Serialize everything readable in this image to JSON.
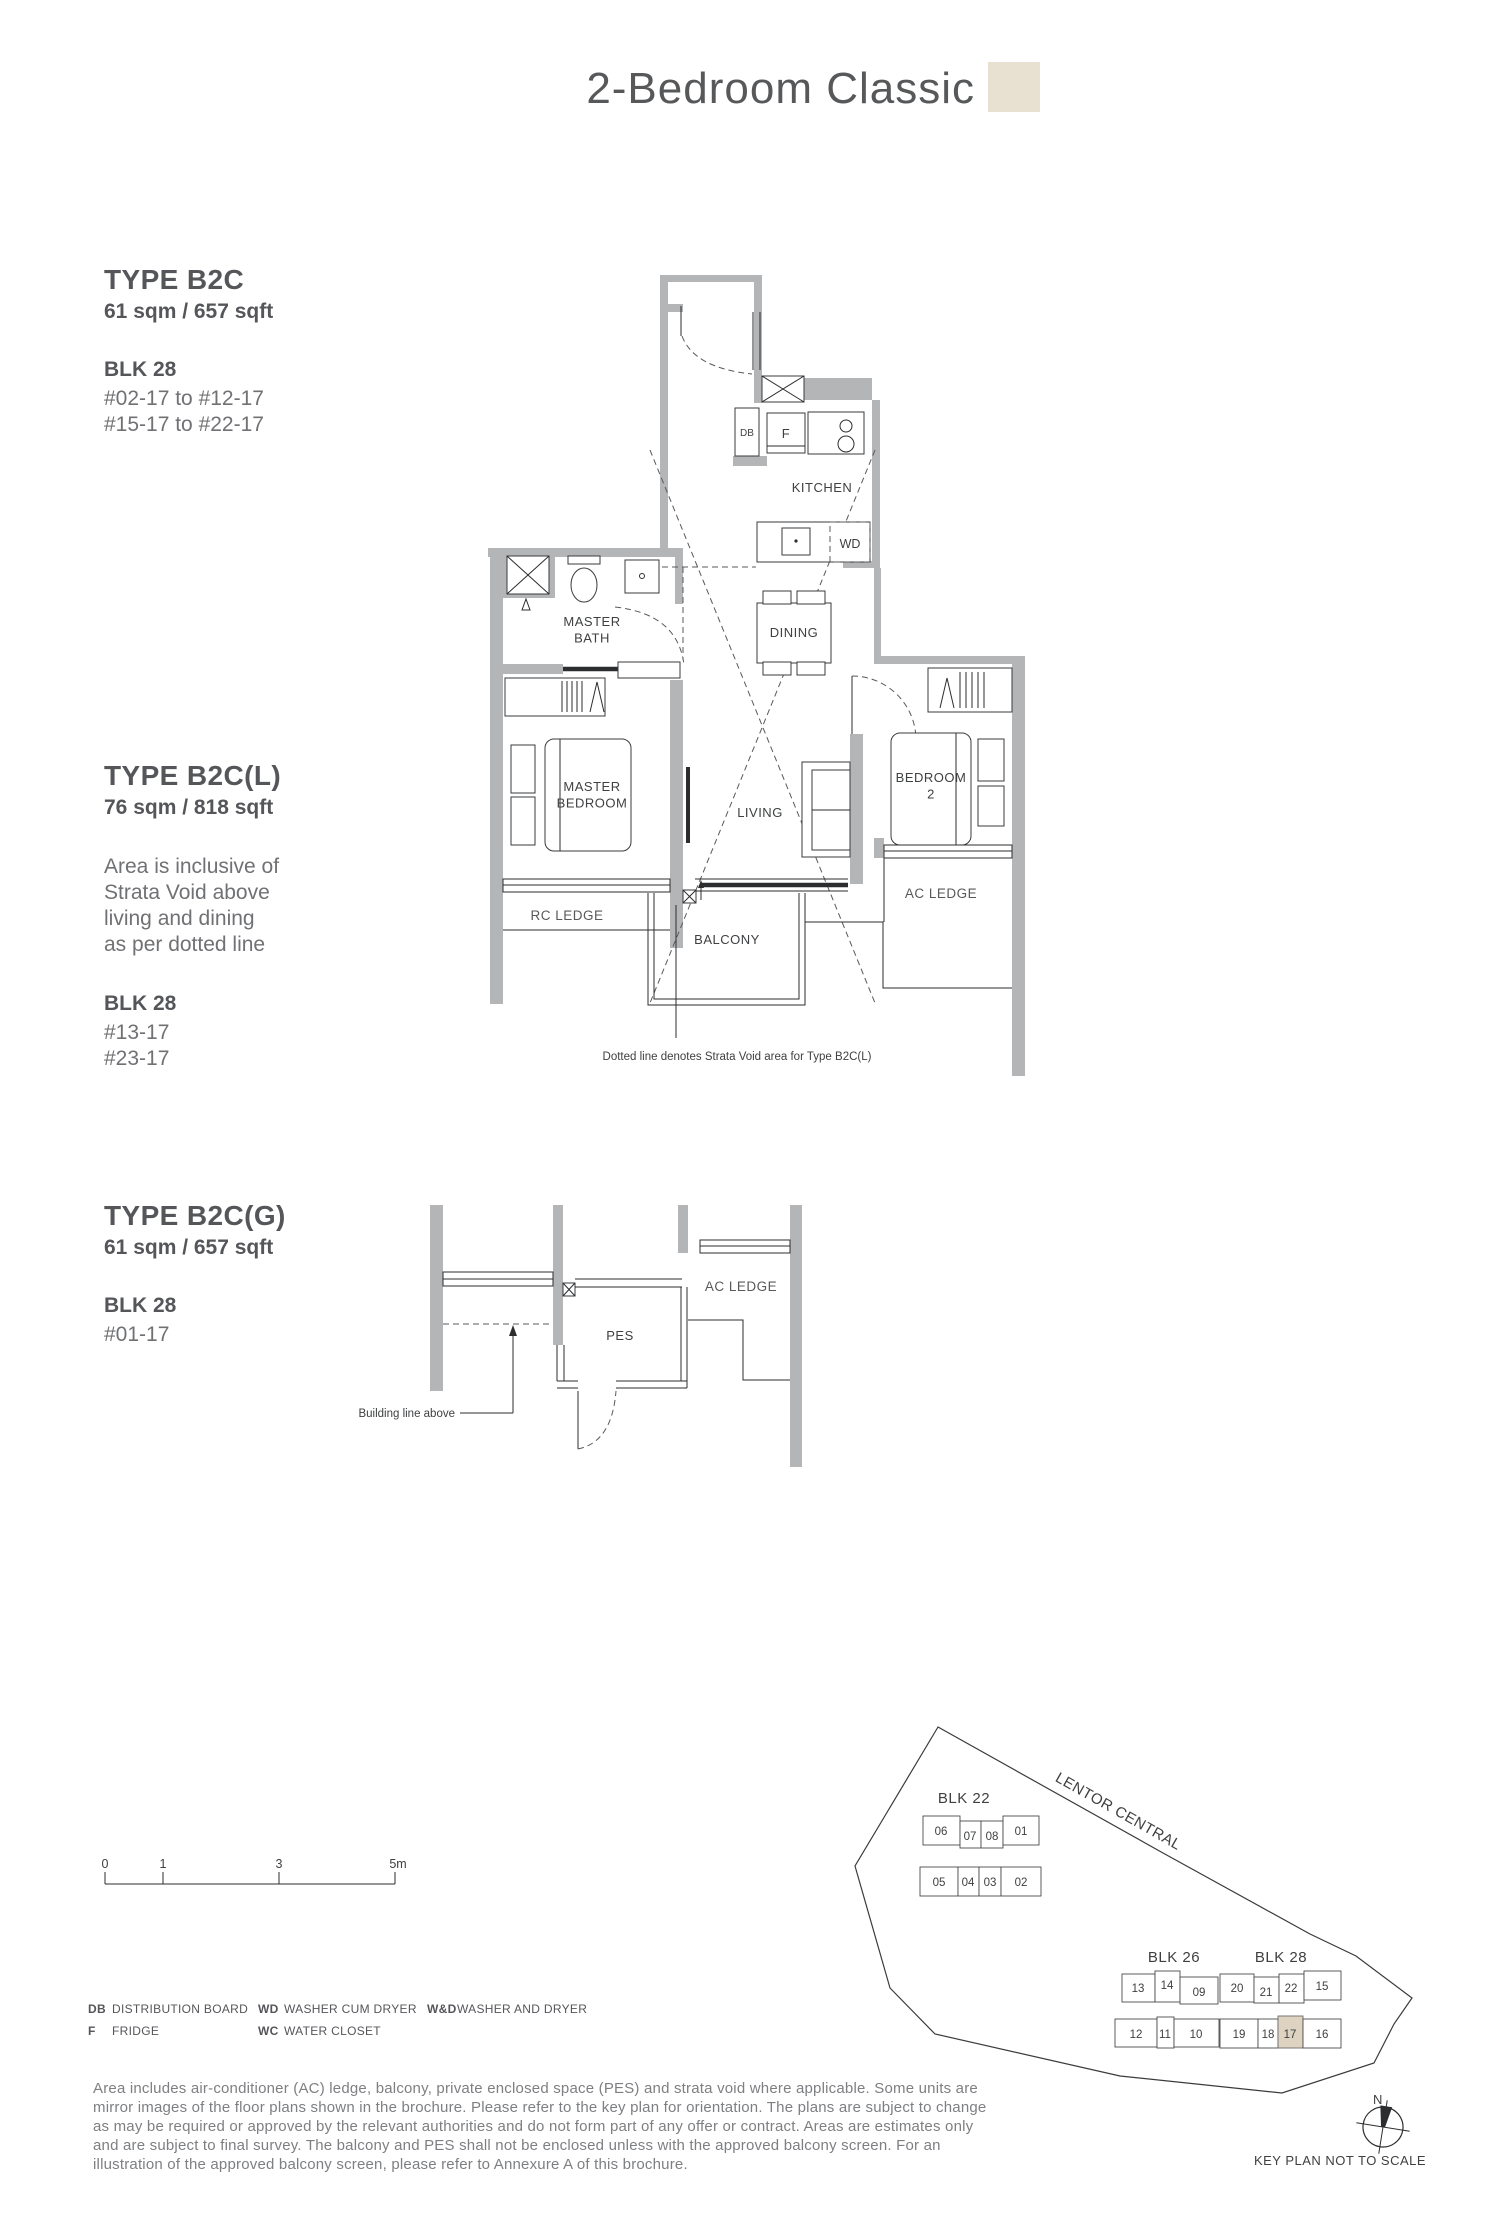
{
  "header": {
    "title": "2-Bedroom Classic"
  },
  "types": [
    {
      "name": "TYPE B2C",
      "area": "61 sqm / 657 sqft",
      "blk": "BLK 28",
      "units": [
        "#02-17 to #12-17",
        "#15-17 to #22-17"
      ]
    },
    {
      "name": "TYPE B2C(L)",
      "area": "76 sqm / 818 sqft",
      "note_lines": [
        "Area is inclusive of",
        "Strata Void above",
        "living and dining",
        "as per dotted line"
      ],
      "blk": "BLK 28",
      "units": [
        "#13-17",
        "#23-17"
      ]
    },
    {
      "name": "TYPE B2C(G)",
      "area": "61 sqm / 657 sqft",
      "blk": "BLK 28",
      "units": [
        "#01-17"
      ]
    }
  ],
  "plan_b2c": {
    "labels": {
      "db": "DB",
      "f": "F",
      "kitchen": "KITCHEN",
      "wd": "WD",
      "dining": "DINING",
      "master_bath": [
        "MASTER",
        "BATH"
      ],
      "master_bedroom": [
        "MASTER",
        "BEDROOM"
      ],
      "living": "LIVING",
      "bedroom2": [
        "BEDROOM",
        "2"
      ],
      "rc_ledge": "RC LEDGE",
      "ac_ledge": "AC LEDGE",
      "balcony": "BALCONY"
    },
    "note": "Dotted line denotes Strata Void area for Type B2C(L)"
  },
  "plan_b2cg": {
    "labels": {
      "pes": "PES",
      "ac_ledge": "AC LEDGE"
    },
    "annotation": "Building line above"
  },
  "scale_bar": {
    "ticks": [
      "0",
      "1",
      "3",
      "5m"
    ]
  },
  "legend": {
    "col1": [
      {
        "abbr": "DB",
        "label": "DISTRIBUTION BOARD"
      },
      {
        "abbr": "F",
        "label": "FRIDGE"
      }
    ],
    "col2": [
      {
        "abbr": "WD",
        "label": "WASHER CUM DRYER"
      },
      {
        "abbr": "WC",
        "label": "WATER CLOSET"
      }
    ],
    "col3": [
      {
        "abbr": "W&D",
        "label": "WASHER AND DRYER"
      }
    ]
  },
  "disclaimer": "Area includes air-conditioner (AC) ledge, balcony, private enclosed space (PES) and strata void where applicable. Some units are mirror images of the floor plans shown in the brochure. Please refer to the key plan for orientation. The plans are subject to change as may be required or approved by the relevant authorities and do not form part of any offer or contract. Areas are estimates only and are subject to final survey. The balcony and PES shall not be enclosed unless with the approved balcony screen. For an illustration of the approved balcony screen, please refer to Annexure A of this brochure.",
  "keyplan": {
    "road": "LENTOR CENTRAL",
    "blocks": [
      {
        "name": "BLK 22",
        "units": [
          "06",
          "07",
          "08",
          "01",
          "05",
          "04",
          "03",
          "02"
        ]
      },
      {
        "name": "BLK 26",
        "units": [
          "13",
          "14",
          "09",
          "12",
          "11",
          "10"
        ]
      },
      {
        "name": "BLK 28",
        "units": [
          "20",
          "21",
          "22",
          "15",
          "19",
          "18",
          "17",
          "16"
        ],
        "highlight": "17"
      }
    ],
    "north": "N",
    "caption": "KEY PLAN NOT TO SCALE"
  },
  "colors": {
    "accent_beige": "#e8e1d1",
    "highlight_unit": "#ddd3c0",
    "wall_gray": "#b4b5b7",
    "heading_gray": "#56575a"
  }
}
